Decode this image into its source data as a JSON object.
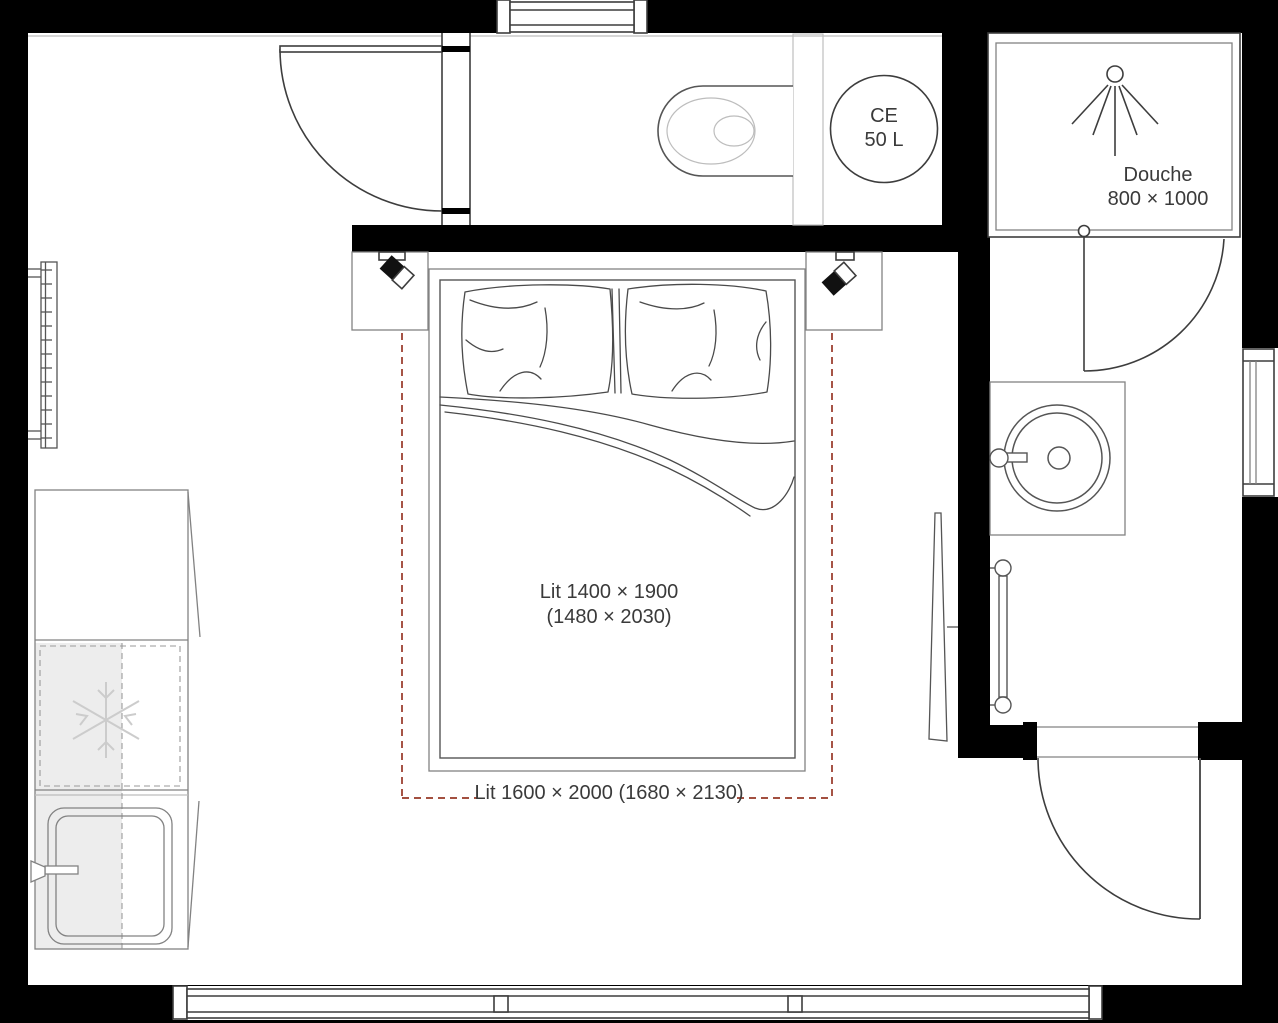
{
  "plan": {
    "labels": {
      "water_heater_line1": "CE",
      "water_heater_line2": "50 L",
      "shower_line1": "Douche",
      "shower_line2": "800 × 1000",
      "bed_line1": "Lit 1400 × 1900",
      "bed_line2": "(1480 × 2030)",
      "bed_alternative": "Lit 1600 × 2000 (1680 × 2130)"
    },
    "colors": {
      "wall": "#000000",
      "line_dark": "#3d3d3d",
      "line_mid": "#828282",
      "line_light": "#bdbdbd",
      "fill_light": "#ededed",
      "accent_dashed": "#963726",
      "text": "#3a3a3a",
      "background": "#ffffff"
    }
  }
}
